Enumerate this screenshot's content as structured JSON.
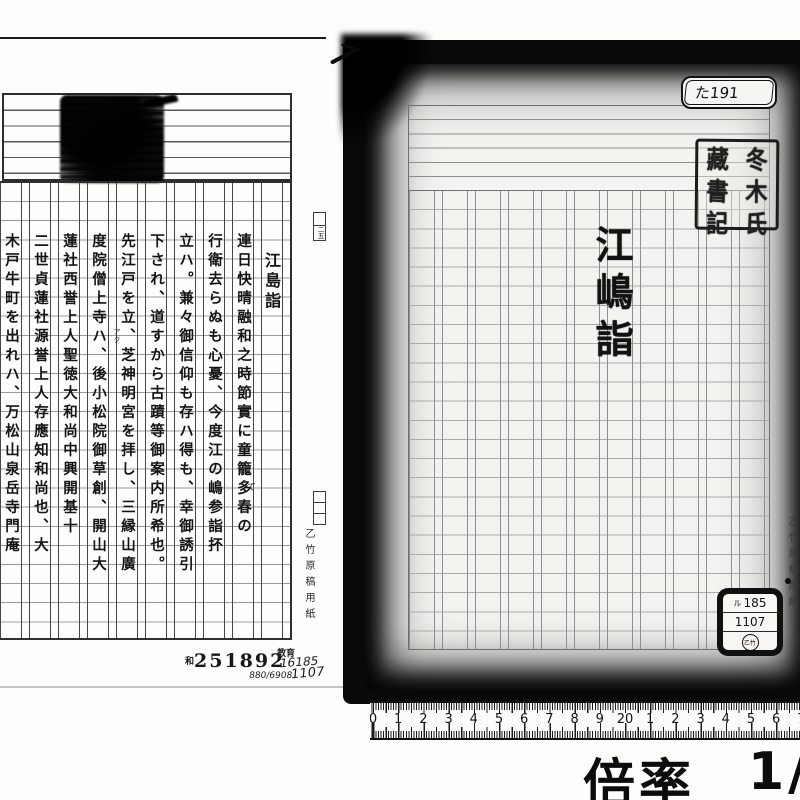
{
  "left_page": {
    "title": "江島詣",
    "text_columns": [
      "連日快晴融和之時節實に童籠多春の",
      "行衛去らぬも心憂、今度江の嶋参詣抔",
      "立ハ。兼々御信仰も存ハ得も、幸御誘引",
      "下され、道すから古蹟等御案内所希也。",
      "先江戸を立、芝神明宮を拝し、三縁山廣",
      "度院僧上寺ハ、後小松院御草創、開山大",
      "蓮社西誉上人聖徳大和尚中興開基十",
      "二世貞蓮社源誉上人存應知和尚也、大",
      "木戸牛町を出れハ、万松山泉岳寺門庵"
    ],
    "reading_note": "アク",
    "correction_note": "て",
    "margin_box_label": "二五",
    "paper_brand": "乙竹原稿用紙",
    "stamp_prefix": "和",
    "stamp_number": "251892",
    "note_label": "教育",
    "note_number1": "16185",
    "note_number2": "1107",
    "note_number3": "880/6908"
  },
  "right_page": {
    "call_number": "た191",
    "title": "江嶋詣",
    "seal_glyphs": [
      "冬",
      "木",
      "氏",
      "藏",
      "書",
      "記"
    ],
    "sticker": {
      "line1_prefix": "ル",
      "line1": "185",
      "line2": "1107",
      "circle": "乙竹"
    },
    "paper_brand": "乙竹原稿用紙"
  },
  "ruler_numbers": [
    "0",
    "1",
    "2",
    "3",
    "4",
    "5",
    "6",
    "7",
    "8",
    "9",
    "20",
    "1",
    "2",
    "3",
    "4",
    "5",
    "6",
    "7"
  ],
  "magnification": {
    "label": "倍率",
    "value": "1/"
  }
}
